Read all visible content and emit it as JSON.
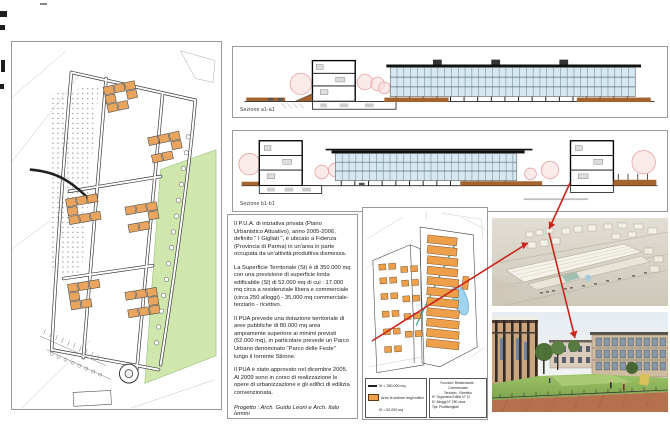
{
  "board": {
    "type": "Tavola di progetto urbanistico (P.U.A.)"
  },
  "sections": {
    "caption_a": "Sezione a1-a1",
    "caption_b": "Sezione b1-b1"
  },
  "description": {
    "paragraphs": [
      "Il P.U.A. di iniziativa privata (Piano Urbanistico Attuativo), anno 2005-2006, definito \" I Gigliati \", è ubicato a Fidenza (Provincia di Parma) in un'area in parte occupata da un'attività produttiva dismessa.",
      "La Superficie Territoriale (St) è di 350.000 mq con una previsione di superficie lorda edificabile (Sl) di 52.000 mq di cui : 17.000 mq circa a residenziale libera e commerciale (circa 250 alloggi) - 35.000 mq commerciale- terziario - ricettivo.",
      "Il PUA prevede una dotazione territoriale di aree pubbliche di 80.000 mq area ampiamente superiore ai minimi previsti (52.000 mq), in particolare prevede un Parco Urbano denominato \"Parco delle Feste\" lungo il torrente Stirone.",
      "Il PUA è stato approvato nel dicembre 2005. Al 2009 sono in corso di realizzazione le opere di urbanizzazione e gli edifici di edilizia convenzionata."
    ],
    "credits": "Progetto : Arch. Guido Leoni e Arch. Italo Iemmi"
  },
  "masterplan": {
    "legend": {
      "items": [
        {
          "symbol": "line",
          "label": "St = 350.000 mq"
        },
        {
          "symbol": "orange",
          "label": "Aree di sedime degli edifici"
        },
        {
          "symbol": "blank",
          "label": "Sl = 52.000 mq"
        }
      ]
    },
    "info_box": {
      "lines": [
        "Funzioni: Residenziale - Commerciale",
        "Terziario - Ricettivo",
        "N° Organismi Edilizi N° 11",
        "N° Alloggi N° 250 circa",
        "Tipi: Plurifamigliari"
      ]
    }
  },
  "colors": {
    "accent_red": "#c9251c",
    "building_orange": "#e9a55e",
    "masterplan_orange": "#ee9f4a",
    "park_green": "#cfe7ad",
    "glass_blue": "#d7e7ef",
    "ground_brown": "#a5632e",
    "pond_blue": "#9fd4ef",
    "teal_line": "#2f9e8a"
  }
}
